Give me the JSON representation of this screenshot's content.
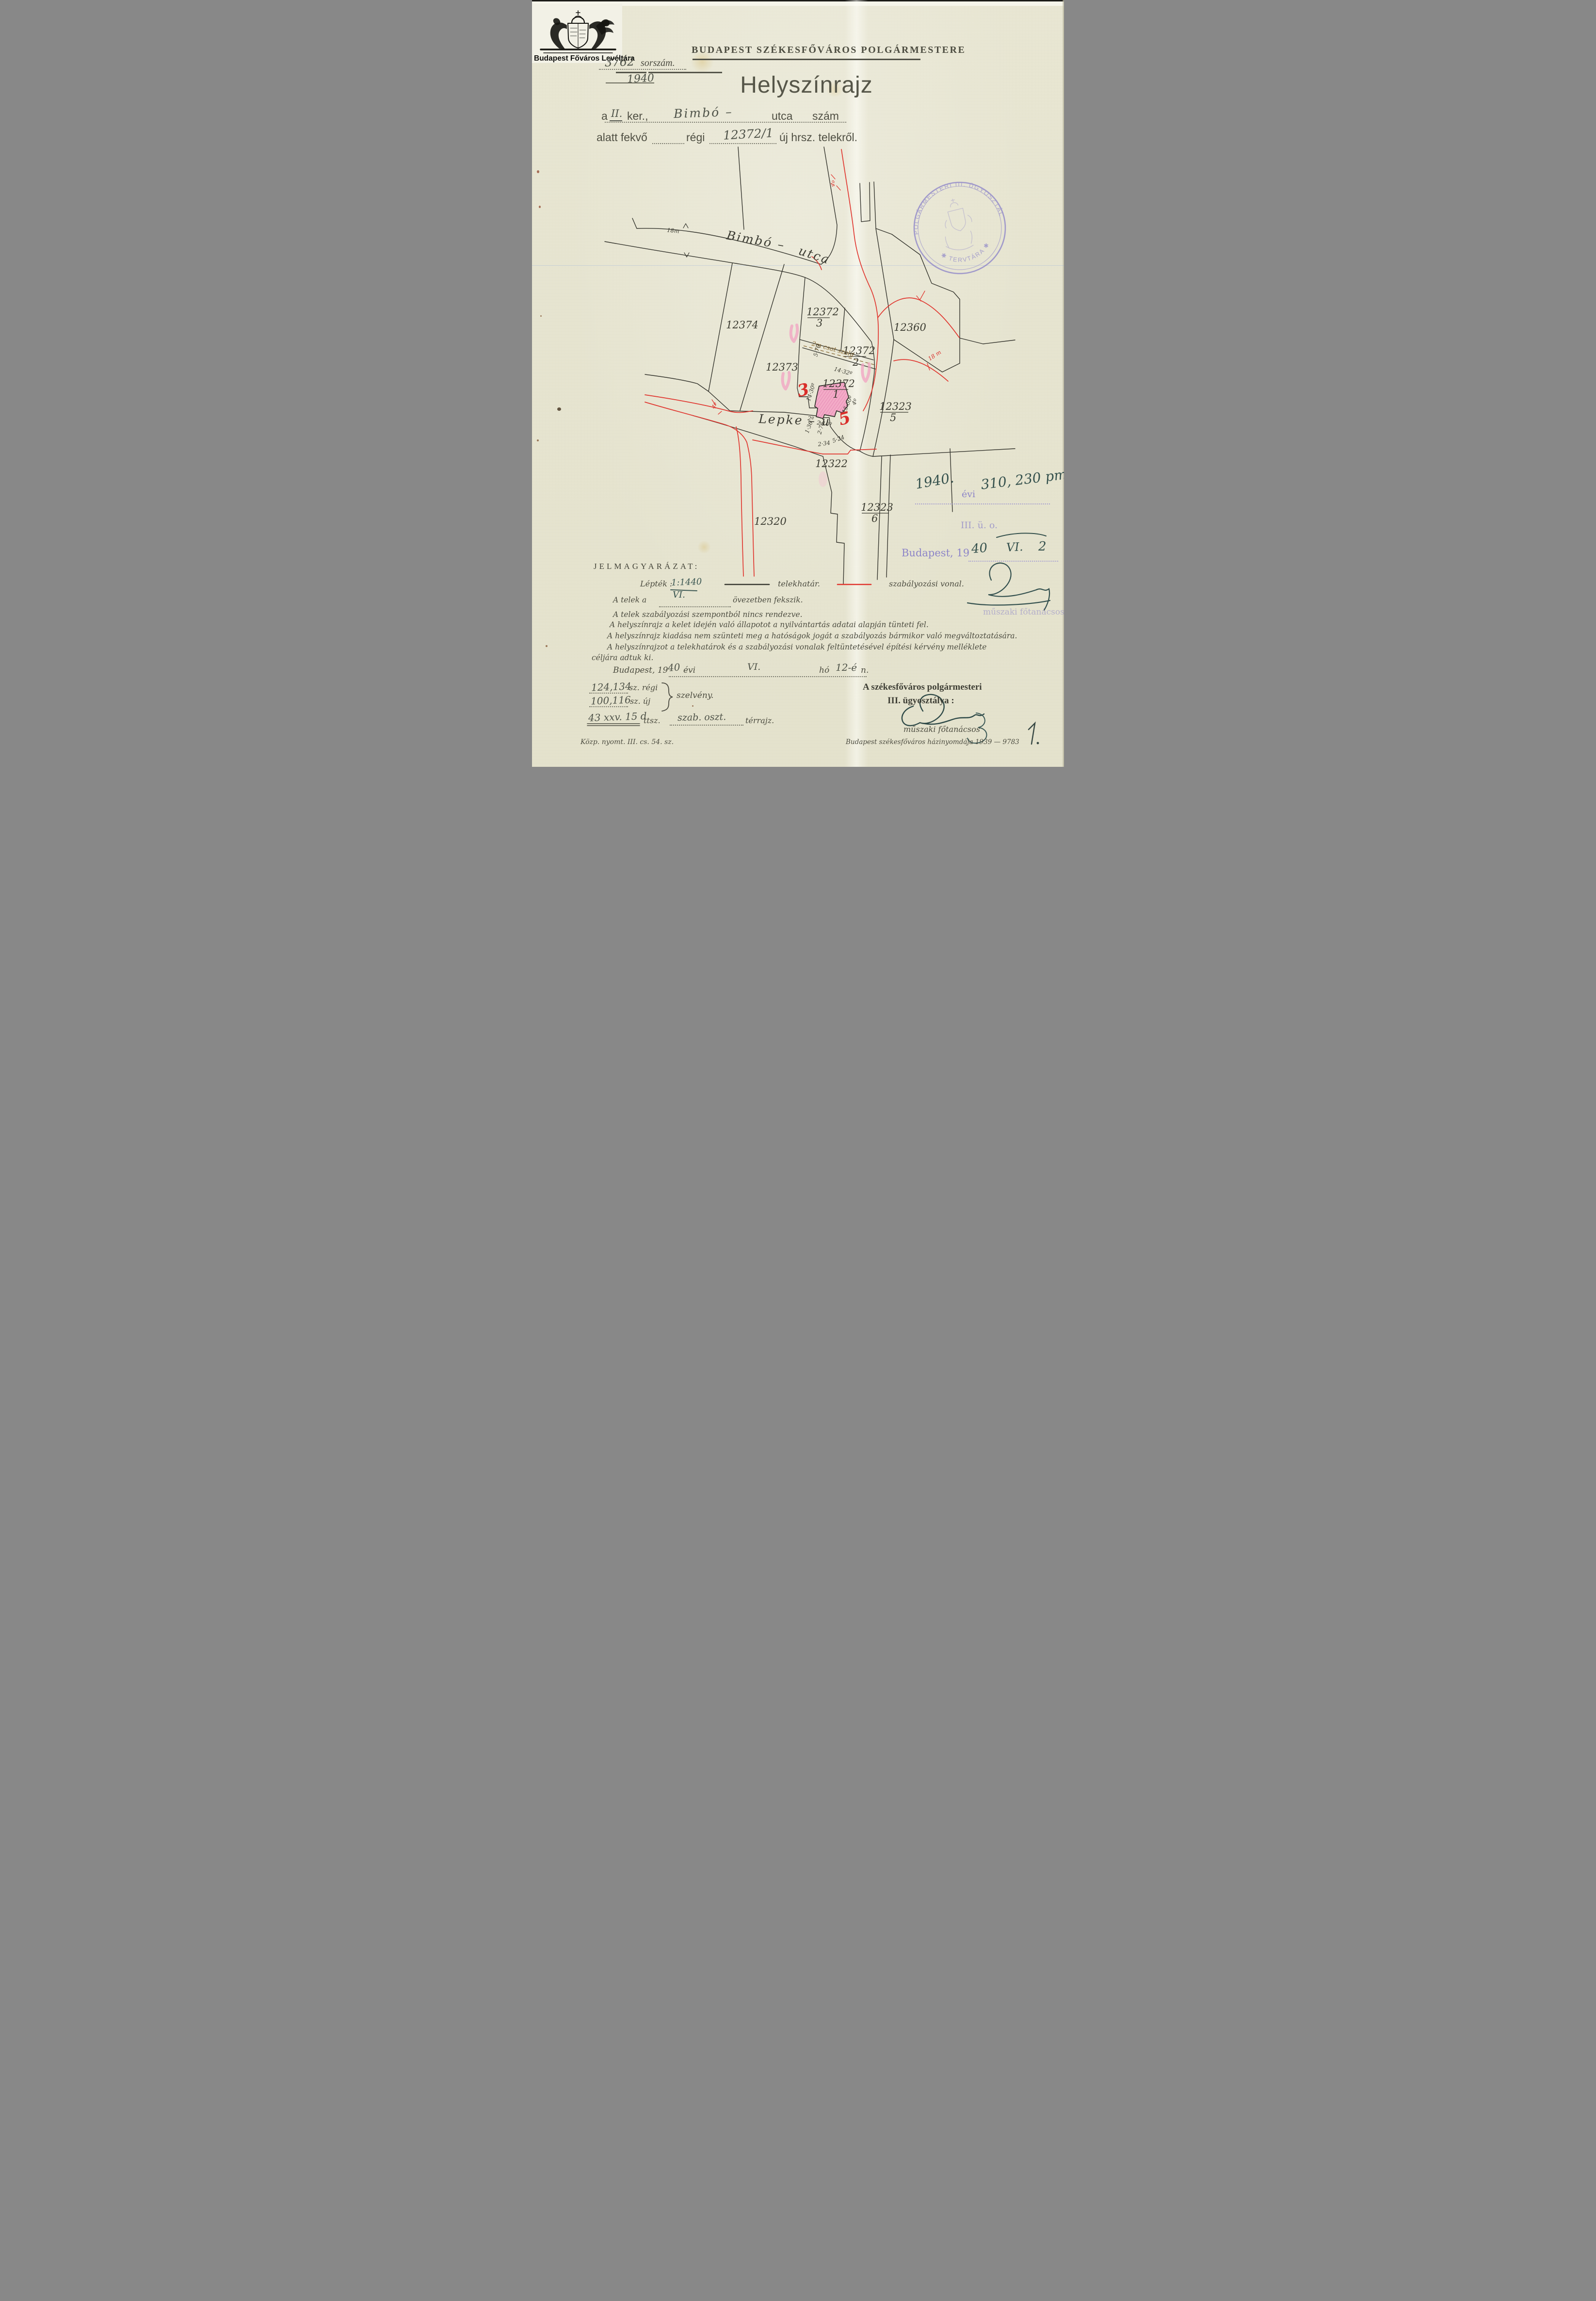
{
  "archive": {
    "caption": "Budapest Főváros Levéltára"
  },
  "header": {
    "office": "BUDAPEST SZÉKESFŐVÁROS POLGÁRMESTERE",
    "serial_value": "3762",
    "serial_label": "sorszám.",
    "serial_year": "1940",
    "title": "Helyszínrajz"
  },
  "form": {
    "l1_a": "a",
    "l1_district": "II.",
    "l1_ker": "ker.,",
    "l1_street": "Bimbó –",
    "l1_utca": "utca",
    "l1_szam": "szám",
    "l2_prefix": "alatt fekvő",
    "l2_regi": "régi",
    "l2_hrsz": "12372/1",
    "l2_suffix": "új hrsz. telekről."
  },
  "map": {
    "w18": "18m",
    "bimbo": "Bimbó –",
    "utca": "utca",
    "lepke": "Lepke – u",
    "p12374": "12374",
    "p12373": "12373",
    "p12360": "12360",
    "p12322": "12322",
    "p12320": "12320",
    "f3n": "12372",
    "f3d": "3",
    "f2n": "12372",
    "f2d": "2",
    "fcn": "12372",
    "fcd": "1",
    "f5n": "12323",
    "f5d": "5",
    "f6n": "12323",
    "f6d": "6",
    "csat": "2m csat szolg",
    "m570": "5·70",
    "m1432": "14·32º",
    "m1430": "14·30º",
    "m1560": "15·60º",
    "m4": "4º",
    "m2": "2º",
    "m210": "2·10º",
    "m276": "2·76",
    "m136": "1·36",
    "m234": "2·34",
    "m524": "5·24",
    "r4top": "4º",
    "r4left": "4º",
    "r18": "18 m",
    "r3": "3",
    "r5": "5"
  },
  "stamp": {
    "arc_top": "A POLGÁRMESTERI III. ÜGYOSZTÁLY",
    "arc_bottom": "✱ TERVTÁRA ✱"
  },
  "notes": {
    "year": "1940.",
    "evi": "évi",
    "file_no": "310, 230 pm",
    "dept": "III. ü. o.",
    "budapest19": "Budapest, 19",
    "date_40": "40",
    "date_vi": "VI.",
    "date_2": "2",
    "title_faint": "műszaki főtanácsos"
  },
  "legend": {
    "heading": "JELMAGYARÁZAT:",
    "scale_label": "Lépték :",
    "scale_value": "1:1440",
    "line1_label": "telekhatár.",
    "line2_label": "szabályozási vonal.",
    "zone_pre": "A telek a",
    "zone_value": "VI.",
    "zone_post": "övezetben fekszik.",
    "s1": "A telek szabályozási szempontból nincs rendezve.",
    "s2": "A helyszínrajz a kelet idején való állapotot a nyilvántartás adatai alapján tünteti fel.",
    "s3": "A helyszínrajz kiadása nem szünteti meg a hatóságok jogát a szabályozás bármikor való megváltoztatására.",
    "s4a": "A helyszínrajzot a telekhatárok és a szabályozási vonalak feltüntetésével építési kérvény melléklete",
    "s4b": "céljára adtuk ki.",
    "date_pre": "Budapest, 19",
    "date_y": "40",
    "date_evi": "évi",
    "date_month": "VI.",
    "date_ho": "hó",
    "date_day": "12-é",
    "date_suffix": "n."
  },
  "sections": {
    "old_no": "124,134",
    "old_sz": "sz. régi",
    "new_no": "100,116",
    "new_sz": "sz. új",
    "szelveny": "szelvény.",
    "ttsz_no": "43 xxv. 15 d",
    "ttsz": "ttsz.",
    "szab": "szab. oszt.",
    "terrajz": "térrajz."
  },
  "signoff": {
    "line1": "A székesfőváros polgármesteri",
    "line2": "III. ügyosztálya :",
    "title": "műszaki főtanácsos",
    "page_no": "1."
  },
  "footer": {
    "left": "Közp. nyomt. III. cs. 54. sz.",
    "right": "Budapest székesfőváros házinyomdája 1939 — 9783"
  }
}
